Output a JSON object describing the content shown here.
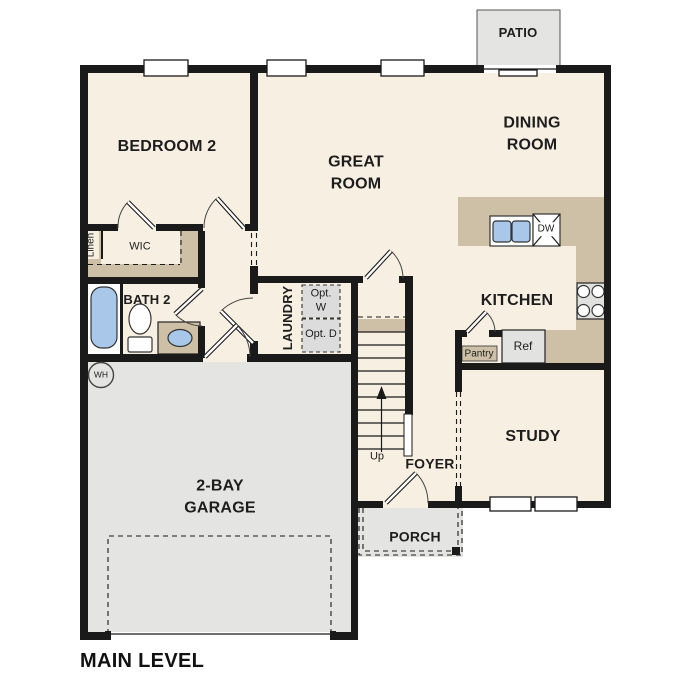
{
  "plan_title": "MAIN LEVEL",
  "rooms": {
    "patio": "PATIO",
    "bedroom2": "BEDROOM 2",
    "great_room": "GREAT ROOM",
    "dining_room": "DINING ROOM",
    "kitchen": "KITCHEN",
    "bath2": "BATH 2",
    "wic": "WIC",
    "linen": "Linen",
    "laundry": "LAUNDRY",
    "foyer": "FOYER",
    "study": "STUDY",
    "porch": "PORCH",
    "garage": "2-BAY GARAGE"
  },
  "fixtures": {
    "opt_washer": "Opt. W",
    "opt_dryer": "Opt. D",
    "pantry": "Pantry",
    "refrigerator": "Ref",
    "dishwasher": "DW",
    "water_heater": "WH",
    "stairs_up": "Up"
  },
  "colors": {
    "floor": "#f7efe2",
    "hardscape": "#e4e4e2",
    "counter": "#cdc0a6",
    "plumbing": "#a9c8e9",
    "wall": "#1a1a1a",
    "appliance": "#e0e0de",
    "option_box": "#dcdcdc"
  }
}
